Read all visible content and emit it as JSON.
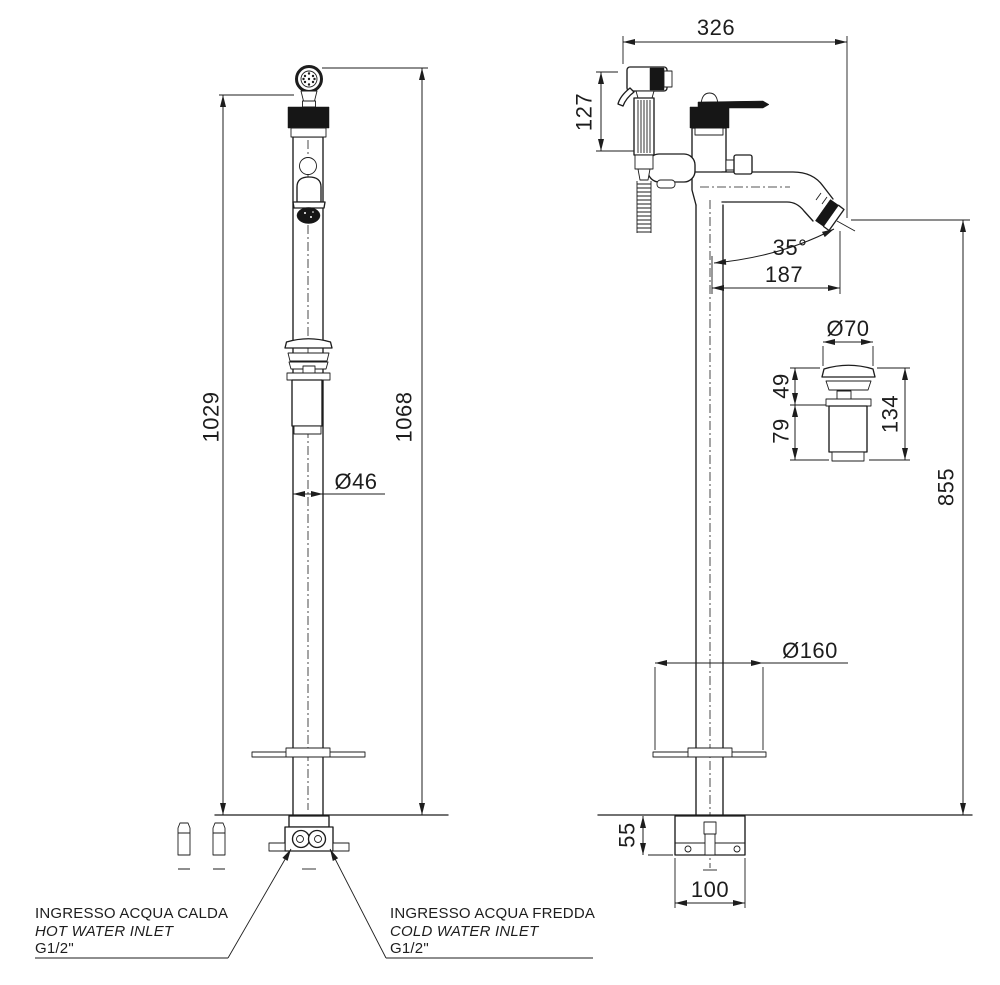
{
  "drawing": {
    "front_view": {
      "height_to_shower_rest": "1029",
      "overall_height": "1068",
      "column_diameter": "Ø46"
    },
    "side_view": {
      "overall_depth": "326",
      "hand_shower_length": "127",
      "spout_angle": "35°",
      "spout_reach": "187",
      "spout_outlet_height": "855",
      "base_cover_diameter": "Ø160",
      "base_height": "55",
      "base_width": "100"
    },
    "drain_detail": {
      "cap_diameter": "Ø70",
      "upper_height": "49",
      "lower_height": "79",
      "overall_height": "134"
    },
    "labels": {
      "hot_inlet": {
        "title": "INGRESSO ACQUA CALDA",
        "subtitle": "HOT WATER INLET",
        "thread": "G1/2\""
      },
      "cold_inlet": {
        "title": "INGRESSO ACQUA FREDDA",
        "subtitle": "COLD WATER INLET",
        "thread": "G1/2\""
      }
    },
    "colors": {
      "line": "#1d1d1d",
      "background": "#ffffff"
    }
  }
}
